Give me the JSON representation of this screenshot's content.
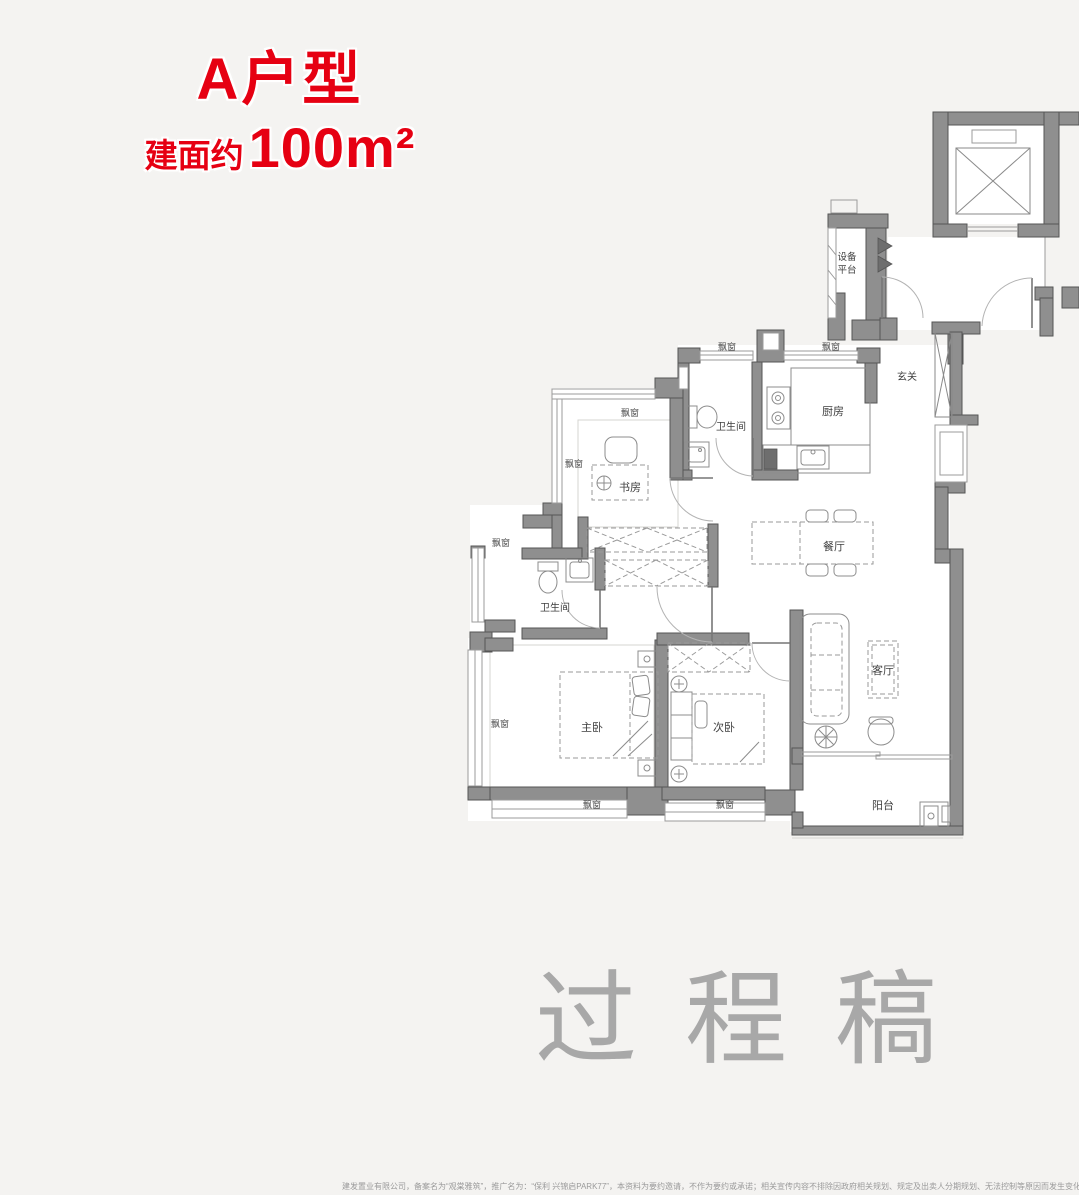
{
  "header": {
    "title": "A户型",
    "area_prefix": "建面约",
    "area_value": "100m²",
    "accent_color": "#e60012"
  },
  "floorplan": {
    "rooms": {
      "study": "书房",
      "bath_upper": "卫生间",
      "kitchen": "厨房",
      "foyer": "玄关",
      "dining": "餐厅",
      "bath_lower": "卫生间",
      "master_bedroom": "主卧",
      "second_bedroom": "次卧",
      "living": "客厅",
      "balcony": "阳台",
      "equipment_line1": "设备",
      "equipment_line2": "平台"
    },
    "bay_window_label": "飘窗",
    "wall_color": "#8f8f8f"
  },
  "watermark": "过程稿",
  "disclaimer": "建发置业有限公司，备案名为“观棠雅筑”，推广名为：“保利 兴锦启PARK77”，本资料为要约邀请，不作为要约或承诺；相关宣传内容不排除因政府相关规划、规定及出卖人分期规划、无法控制等原因而发生变化；买卖双方的权利义"
}
